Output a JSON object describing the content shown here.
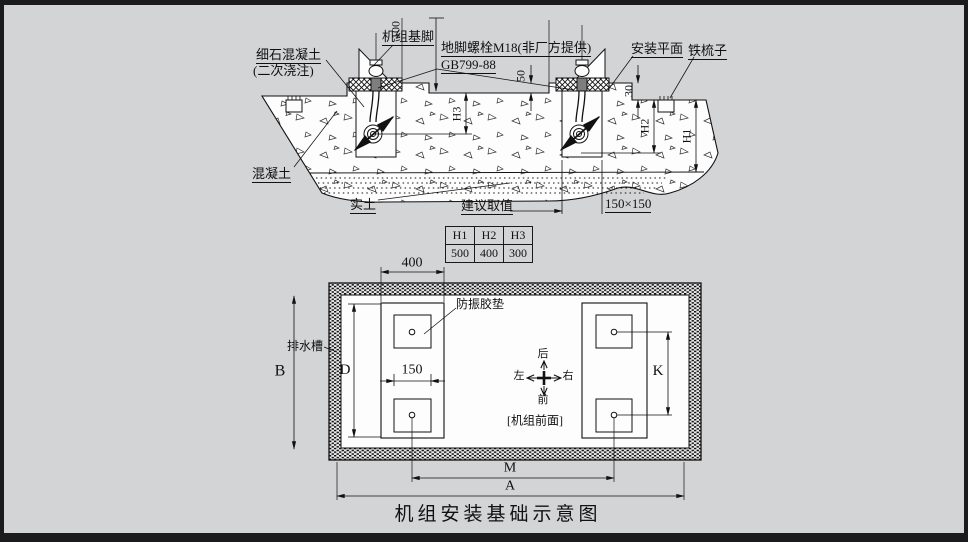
{
  "section": {
    "fine_concrete_line1": "细石混凝土",
    "fine_concrete_line2": "(二次浇注)",
    "machine_foot": "机组基脚",
    "anchor_bolt": "地脚螺栓M18(非厂方提供)",
    "anchor_bolt_standard": "GB799-88",
    "mounting_plane": "安装平面",
    "iron_comb": "铁梳子",
    "concrete": "混凝土",
    "solid_soil": "实土",
    "dims": {
      "top_clearance": "100",
      "grout_step": "50",
      "comb_step": "30",
      "h3": "H3",
      "h2": "H2",
      "h1": "H1",
      "pocket": "150×150"
    }
  },
  "suggestion_table": {
    "title": "建议取值",
    "headers": [
      "H1",
      "H2",
      "H3"
    ],
    "values": [
      "500",
      "400",
      "300"
    ]
  },
  "plan": {
    "vibration_pad": "防振胶垫",
    "drain_channel": "排水槽",
    "unit_front": "[机组前面]",
    "directions": {
      "back": "后",
      "front": "前",
      "left": "左",
      "right": "右"
    },
    "dims": {
      "foot_span": "400",
      "pad_pitch": "150",
      "b": "B",
      "d": "D",
      "k": "K",
      "m": "M",
      "a": "A"
    }
  },
  "caption": "机组安装基础示意图"
}
